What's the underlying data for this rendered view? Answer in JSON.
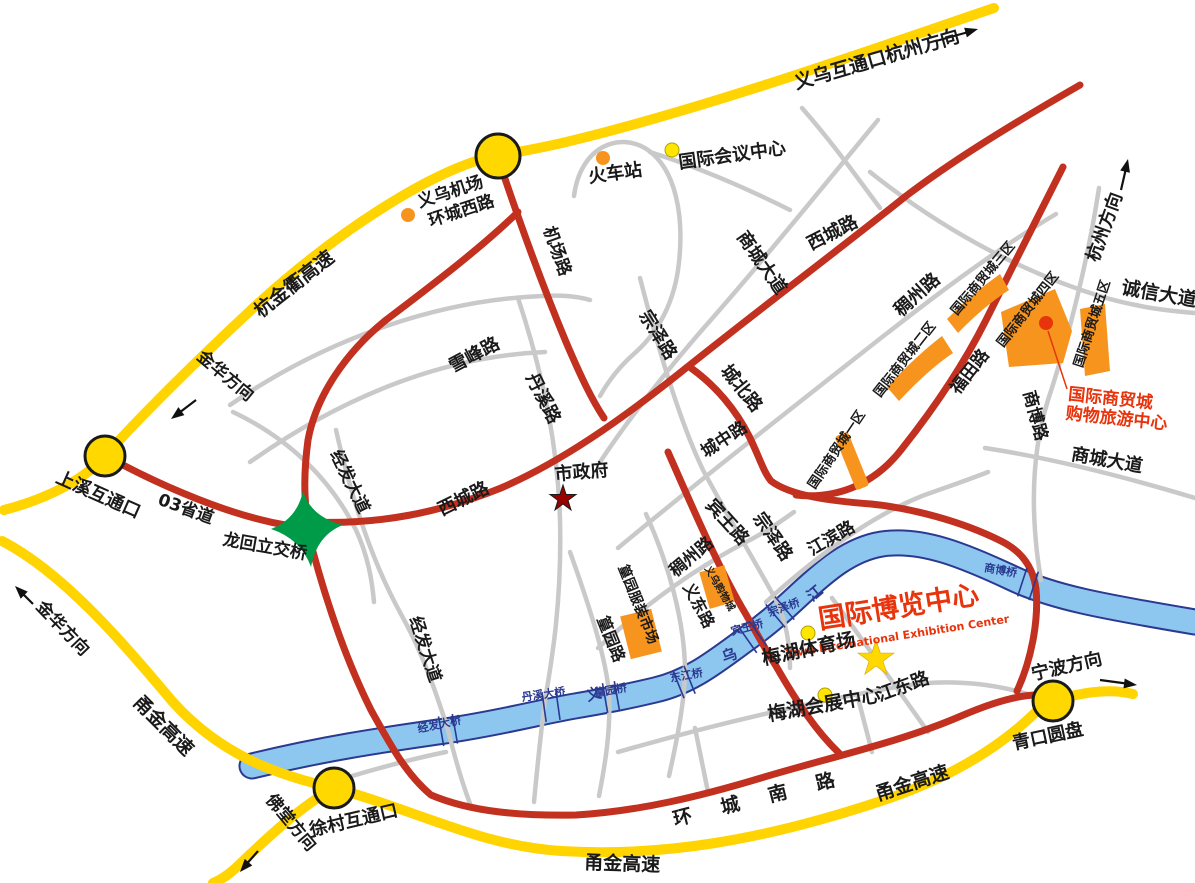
{
  "colors": {
    "highway_yellow": "#ffd400",
    "main_road_red": "#c2301f",
    "minor_road_gray": "#c9c9c9",
    "river_fill": "#8dc7f0",
    "river_edge": "#2b3990",
    "building_orange": "#f7941d",
    "poi_red": "#e8340c",
    "interchange_green": "#009b48",
    "gov_star_red": "#990000",
    "stadium_star_yellow": "#ffd800"
  },
  "highways": {
    "hangjinqu": "杭金衢高速",
    "yongjin": "甬金高速",
    "s03": "03省道"
  },
  "directions": {
    "hangzhou": "杭州方向",
    "jinhua": "金华方向",
    "ningbo": "宁波方向",
    "futang": "佛堂方向"
  },
  "interchanges": {
    "yiwu": "义乌互通口",
    "shangxi": "上溪互通口",
    "xucun": "徐村互通口",
    "qingkou": "青口圆盘",
    "longhui": "龙回立交桥"
  },
  "roads": {
    "huancheng_xi": "环城西路",
    "jichang": "机场路",
    "jingfa": "经发大道",
    "xicheng": "西城路",
    "xuefeng": "雪峰路",
    "danxi": "丹溪路",
    "zongze": "宗泽路",
    "chengbei": "城北路",
    "chengzhong": "城中路",
    "binwang": "宾王路",
    "jiangbin": "江滨路",
    "chouzhou": "稠州路",
    "shangcheng": "商城大道",
    "futian": "福田路",
    "shangbo": "商博路",
    "chengxin": "诚信大道",
    "huangyuan": "篁园路",
    "yidong": "义东路",
    "jiangdong": "江东路",
    "huancheng_nan": "环城南路"
  },
  "pois": {
    "airport": "义乌机场",
    "train_station": "火车站",
    "conference_center": "国际会议中心",
    "city_hall": "市政府",
    "expo_center": "国际博览中心",
    "expo_center_en": "Yiwu International Exhibition Center",
    "meihu_stadium": "梅湖体育场",
    "meihu_exhibition_center": "梅湖会展中心",
    "shopping_tourism_line1": "国际商贸城",
    "shopping_tourism_line2": "购物旅游中心",
    "huangyuan_market": "篁园服装市场",
    "yiwu_shopping_city": "义乌购物城"
  },
  "zones": {
    "z1": "国际商贸城一区",
    "z2": "国际商贸城二区",
    "z3": "国际商贸城三区",
    "z4": "国际商贸城四区",
    "z5": "国际商贸城五区"
  },
  "bridges": {
    "zongze": "宗泽桥",
    "binwang": "宾王桥",
    "shangbo": "商博桥",
    "dongjiang": "东江桥",
    "huangyuan": "篁园桥",
    "danxi": "丹溪大桥",
    "jingfa": "经发大桥"
  },
  "river": {
    "char1": "义",
    "char2": "乌",
    "char3": "江"
  }
}
